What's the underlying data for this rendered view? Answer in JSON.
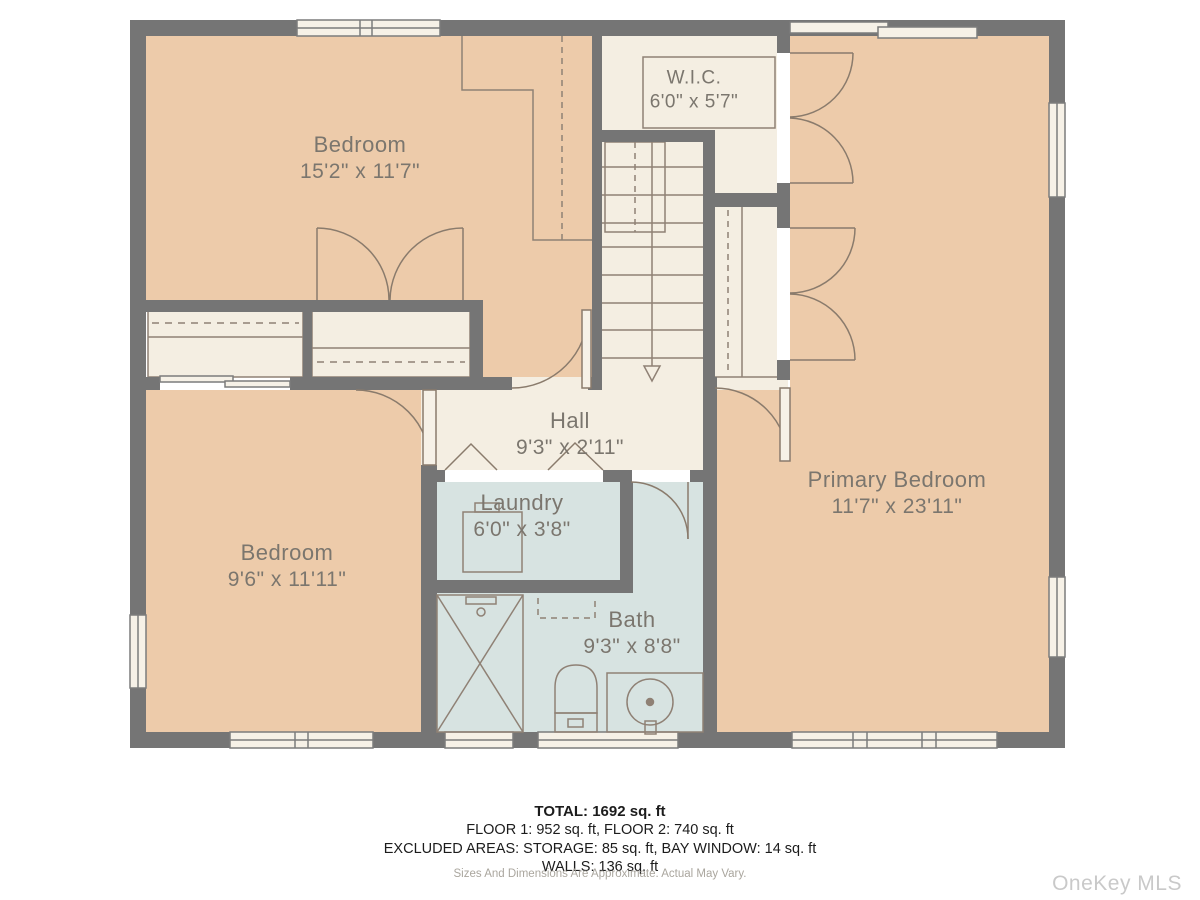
{
  "plan": {
    "rooms": {
      "bedroom_top": {
        "name": "Bedroom",
        "dims": "15'2\" x 11'7\""
      },
      "wic": {
        "name": "W.I.C.",
        "dims": "6'0\" x 5'7\""
      },
      "primary_bedroom": {
        "name": "Primary Bedroom",
        "dims": "11'7\" x 23'11\""
      },
      "hall": {
        "name": "Hall",
        "dims": "9'3\" x 2'11\""
      },
      "laundry": {
        "name": "Laundry",
        "dims": "6'0\" x 3'8\""
      },
      "bedroom_bottom": {
        "name": "Bedroom",
        "dims": "9'6\" x 11'11\""
      },
      "bath": {
        "name": "Bath",
        "dims": "9'3\" x 8'8\""
      }
    },
    "colors": {
      "room_fill": "#edcbaa",
      "corridor_fill": "#f4eee2",
      "wet_room_fill": "#d7e3e1",
      "wall": "#757575",
      "line": "#8f8175",
      "label_text": "#7b766e"
    }
  },
  "footer": {
    "total": "TOTAL: 1692 sq. ft",
    "floors": "FLOOR 1: 952 sq. ft, FLOOR 2: 740 sq. ft",
    "excluded": "EXCLUDED AREAS: STORAGE: 85 sq. ft, BAY WINDOW: 14 sq. ft",
    "walls": "WALLS: 136 sq. ft",
    "disclaimer": "Sizes And Dimensions Are Approximate. Actual May Vary.",
    "watermark": "OneKey MLS"
  }
}
